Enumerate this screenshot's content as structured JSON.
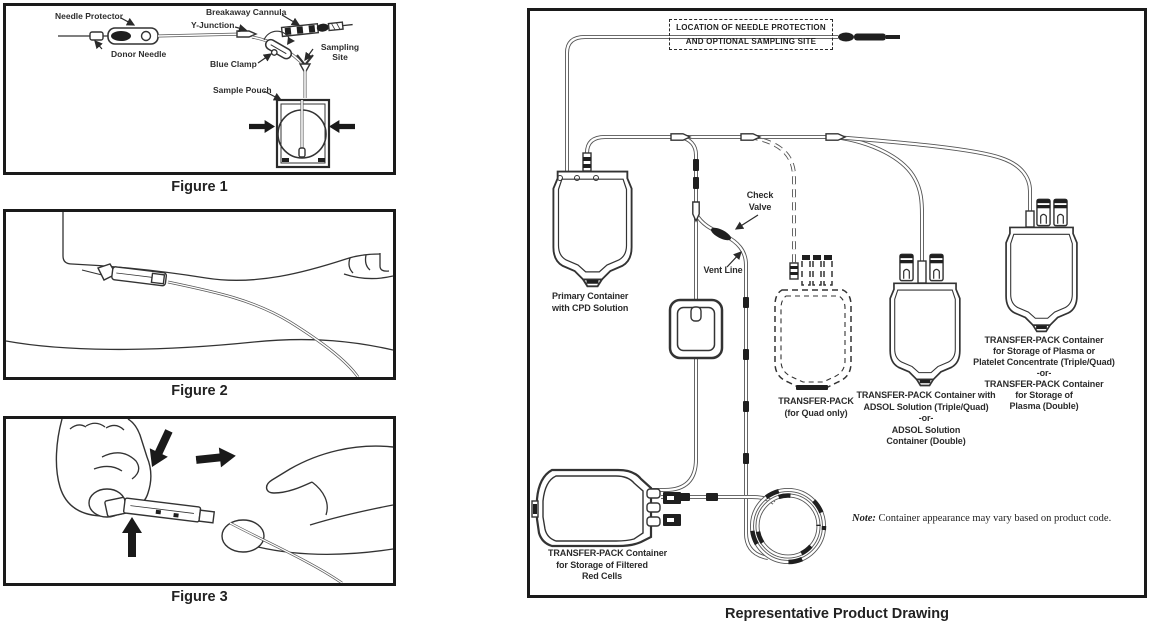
{
  "page": {
    "ink": "#2a2a2a",
    "background": "#ffffff"
  },
  "figures": [
    {
      "id": "figure-1",
      "caption": "Figure 1",
      "labels": {
        "needle_protector": "Needle Protector",
        "donor_needle": "Donor Needle",
        "breakaway_cannula": "Breakaway Cannula",
        "y_junction": "Y-Junction",
        "blue_clamp": "Blue Clamp",
        "sampling_site": "Sampling\nSite",
        "sample_pouch": "Sample Pouch"
      }
    },
    {
      "id": "figure-2",
      "caption": "Figure 2"
    },
    {
      "id": "figure-3",
      "caption": "Figure 3"
    }
  ],
  "product_drawing": {
    "caption": "Representative Product Drawing",
    "location_box": "LOCATION OF NEEDLE PROTECTION\nAND OPTIONAL SAMPLING SITE",
    "labels": {
      "check_valve": "Check\nValve",
      "vent_line": "Vent Line",
      "primary_container": "Primary Container\nwith CPD Solution",
      "quad_pack": "TRANSFER-PACK\n(for Quad only)",
      "adsol_pack": "TRANSFER-PACK Container with\nADSOL Solution (Triple/Quad)\n-or-\nADSOL Solution\nContainer (Double)",
      "plasma_pack": "TRANSFER-PACK Container\nfor Storage of Plasma or\nPlatelet Concentrate (Triple/Quad)\n-or-\nTRANSFER-PACK Container\nfor Storage of\nPlasma (Double)",
      "red_cells_pack": "TRANSFER-PACK Container\nfor Storage of Filtered\nRed Cells"
    },
    "note": {
      "prefix": "Note:",
      "text": " Container appearance may vary based on product code."
    }
  }
}
